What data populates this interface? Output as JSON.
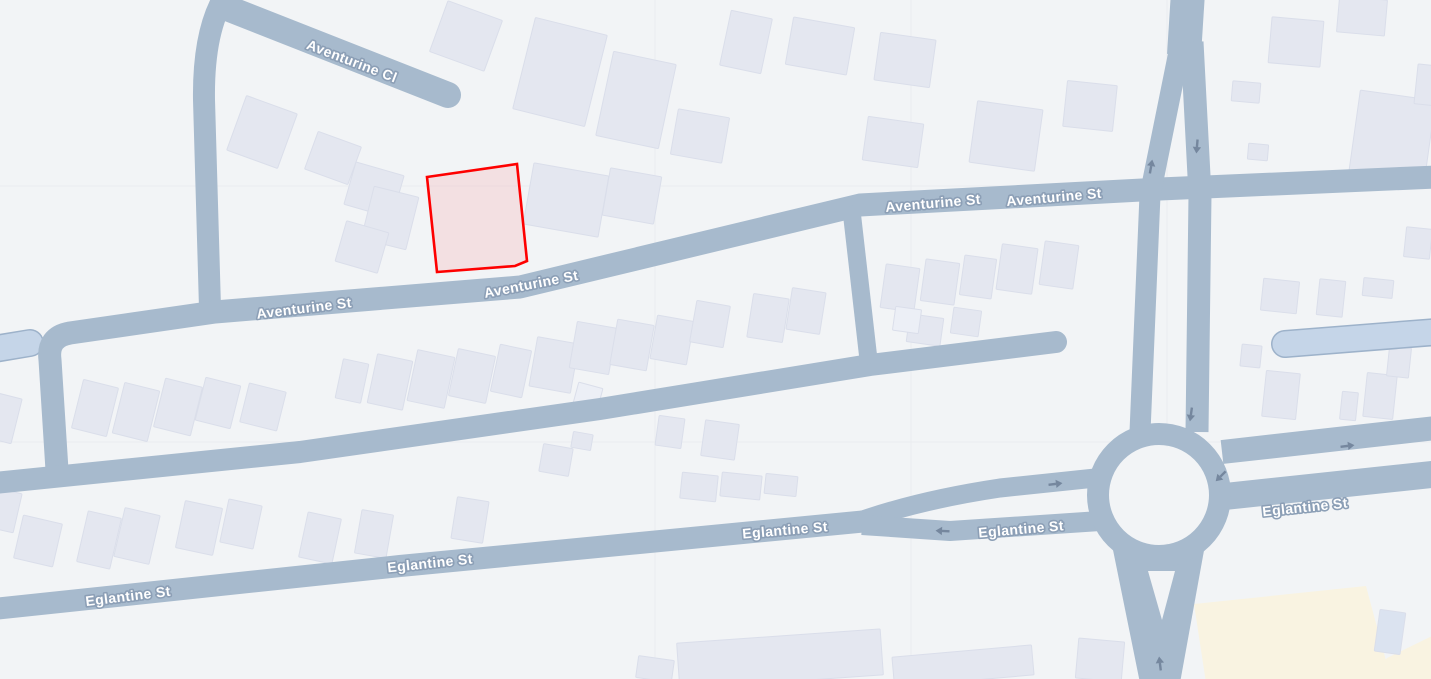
{
  "map": {
    "colors": {
      "bg": "#f2f4f6",
      "tile_line": "#e9ebee",
      "road": "#a7bacd",
      "light_road_fill": "#c5d5e8",
      "light_road_edge": "#9db2ca",
      "building": "#e4e7f0",
      "building_edge": "#dadeea",
      "building_light": "#eceff6",
      "building_blue": "#dbe3f0",
      "landuse": "#f9f3e1",
      "label_fill": "#ffffff",
      "label_halo": "#8c9fb6",
      "arrow": "#75879e",
      "parcel_stroke": "#fe0000",
      "parcel_fill": "rgba(254,0,0,0.08)"
    },
    "labels": [
      {
        "text": "Aventurine Cl",
        "x": 352,
        "y": 61,
        "rot": 21
      },
      {
        "text": "Aventurine St",
        "x": 304,
        "y": 308,
        "rot": -7
      },
      {
        "text": "Aventurine St",
        "x": 531,
        "y": 284,
        "rot": -11
      },
      {
        "text": "Aventurine St",
        "x": 933,
        "y": 203,
        "rot": -5
      },
      {
        "text": "Aventurine St",
        "x": 1054,
        "y": 197,
        "rot": -5
      },
      {
        "text": "Eglantine St",
        "x": 128,
        "y": 596,
        "rot": -7
      },
      {
        "text": "Eglantine St",
        "x": 430,
        "y": 563,
        "rot": -6
      },
      {
        "text": "Eglantine St",
        "x": 785,
        "y": 530,
        "rot": -5
      },
      {
        "text": "Eglantine St",
        "x": 1021,
        "y": 529,
        "rot": -5
      },
      {
        "text": "Eglantine St",
        "x": 1305,
        "y": 507,
        "rot": -6
      }
    ],
    "arrows": [
      {
        "x": 1151,
        "y": 167,
        "rot": -80
      },
      {
        "x": 1197,
        "y": 146,
        "rot": 95
      },
      {
        "x": 1191,
        "y": 414,
        "rot": 98
      },
      {
        "x": 1221,
        "y": 476,
        "rot": 135
      },
      {
        "x": 1347,
        "y": 446,
        "rot": -7
      },
      {
        "x": 1055,
        "y": 484,
        "rot": -7
      },
      {
        "x": 943,
        "y": 531,
        "rot": 183
      },
      {
        "x": 1160,
        "y": 664,
        "rot": -97
      }
    ],
    "roads": [
      {
        "d": "M 222 6 L 448 95",
        "w": 26,
        "cap": "round"
      },
      {
        "d": "M 226 -6 Q 203 30 204 100 L 210 308",
        "w": 22,
        "cap": "butt"
      },
      {
        "d": "M 57 470 L 50 360 Q 47 337 70 333 L 215 312 L 520 287 L 860 205 L 1160 189 L 1436 177",
        "w": 23,
        "cap": "butt"
      },
      {
        "d": "M -6 483 L 300 452 L 600 409 L 870 365 L 1056 342",
        "w": 22,
        "cap": "round"
      },
      {
        "d": "M 851 206 L 869 364",
        "w": 18,
        "cap": "butt"
      },
      {
        "d": "M -6 609 L 400 566 L 868 521",
        "w": 22,
        "cap": "butt"
      },
      {
        "d": "M 860 521 Q 920 500 1000 488 L 1105 477",
        "w": 19,
        "cap": "butt"
      },
      {
        "d": "M 862 525 L 950 531 L 1100 521",
        "w": 20,
        "cap": "butt"
      },
      {
        "d": "M 1222 452 L 1436 428",
        "w": 24,
        "cap": "butt"
      },
      {
        "d": "M 1220 497 L 1436 474",
        "w": 27,
        "cap": "butt"
      },
      {
        "d": "M 1188 -8 L 1184 55",
        "w": 34,
        "cap": "butt"
      },
      {
        "d": "M 1181 42 L 1150 195 L 1140 432",
        "w": 21,
        "cap": "butt"
      },
      {
        "d": "M 1192 42 L 1200 195 L 1197 432",
        "w": 23,
        "cap": "butt"
      }
    ],
    "light_roads": [
      {
        "d": "M -6 349 L 30 343",
        "w": 25
      },
      {
        "d": "M 1285 344 L 1436 332",
        "w": 25
      }
    ],
    "roundabout": {
      "cx": 1159,
      "cy": 495,
      "ring_r": 61,
      "ring_w": 22,
      "hole_r": 49
    },
    "south_leg": {
      "poly": "1112,545 1205,545 1180,683 1140,683",
      "island": "1148,571 1175,571 1162,620"
    },
    "landuse": [
      "1194,604 1366,586 1392,683 1206,683",
      "1387,658 1436,634 1436,683 1362,683"
    ],
    "tile_lines": [
      {
        "x1": 655,
        "y1": 0,
        "x2": 655,
        "y2": 679
      },
      {
        "x1": 911,
        "y1": 0,
        "x2": 911,
        "y2": 679
      },
      {
        "x1": 1167,
        "y1": 0,
        "x2": 1167,
        "y2": 679
      },
      {
        "x1": 0,
        "y1": 186,
        "x2": 1431,
        "y2": 186
      },
      {
        "x1": 0,
        "y1": 442,
        "x2": 1431,
        "y2": 442
      }
    ],
    "buildings": [
      [
        262,
        132,
        54,
        58,
        20
      ],
      [
        333,
        158,
        46,
        40,
        20
      ],
      [
        374,
        190,
        50,
        44,
        16
      ],
      [
        466,
        36,
        58,
        54,
        20
      ],
      [
        560,
        72,
        74,
        94,
        14
      ],
      [
        636,
        100,
        64,
        86,
        12
      ],
      [
        700,
        136,
        52,
        46,
        10
      ],
      [
        746,
        42,
        42,
        56,
        12
      ],
      [
        820,
        46,
        62,
        48,
        10
      ],
      [
        893,
        142,
        56,
        44,
        8
      ],
      [
        905,
        60,
        56,
        48,
        8
      ],
      [
        1006,
        136,
        66,
        62,
        8
      ],
      [
        1090,
        106,
        50,
        46,
        6
      ],
      [
        1246,
        92,
        28,
        20,
        5
      ],
      [
        1296,
        42,
        52,
        46,
        5
      ],
      [
        1362,
        16,
        48,
        36,
        5
      ],
      [
        1392,
        138,
        76,
        86,
        8
      ],
      [
        1258,
        152,
        20,
        16,
        5
      ],
      [
        1428,
        85,
        24,
        40,
        6
      ],
      [
        390,
        218,
        46,
        54,
        14
      ],
      [
        566,
        200,
        76,
        62,
        10
      ],
      [
        632,
        196,
        52,
        48,
        10
      ],
      [
        362,
        247,
        44,
        42,
        16
      ],
      [
        3,
        418,
        28,
        46,
        14
      ],
      [
        95,
        408,
        36,
        50,
        14
      ],
      [
        136,
        412,
        36,
        52,
        14
      ],
      [
        178,
        407,
        38,
        50,
        14
      ],
      [
        218,
        403,
        36,
        44,
        14
      ],
      [
        263,
        407,
        38,
        40,
        14
      ],
      [
        352,
        381,
        26,
        40,
        12
      ],
      [
        390,
        382,
        36,
        50,
        12
      ],
      [
        431,
        379,
        38,
        52,
        12
      ],
      [
        472,
        376,
        38,
        48,
        12
      ],
      [
        511,
        371,
        32,
        48,
        12
      ],
      [
        554,
        365,
        42,
        50,
        10
      ],
      [
        588,
        396,
        25,
        22,
        15,
        "light"
      ],
      [
        593,
        348,
        40,
        47,
        10
      ],
      [
        632,
        345,
        37,
        46,
        10
      ],
      [
        672,
        340,
        37,
        44,
        10
      ],
      [
        710,
        324,
        34,
        42,
        10
      ],
      [
        768,
        318,
        36,
        44,
        9
      ],
      [
        806,
        311,
        34,
        42,
        9
      ],
      [
        900,
        288,
        34,
        44,
        8
      ],
      [
        940,
        282,
        34,
        42,
        8
      ],
      [
        978,
        277,
        32,
        40,
        8
      ],
      [
        1017,
        269,
        36,
        46,
        8
      ],
      [
        1059,
        265,
        34,
        44,
        8
      ],
      [
        925,
        330,
        34,
        28,
        8
      ],
      [
        966,
        322,
        28,
        26,
        8
      ],
      [
        907,
        320,
        26,
        24,
        8,
        "light"
      ],
      [
        1280,
        296,
        36,
        32,
        6
      ],
      [
        1331,
        298,
        26,
        36,
        6
      ],
      [
        1378,
        288,
        30,
        18,
        6
      ],
      [
        1418,
        243,
        26,
        30,
        6
      ],
      [
        1251,
        356,
        20,
        22,
        6
      ],
      [
        1281,
        395,
        34,
        46,
        6
      ],
      [
        1349,
        406,
        16,
        28,
        6
      ],
      [
        1380,
        396,
        30,
        44,
        6
      ],
      [
        1399,
        362,
        22,
        30,
        6
      ],
      [
        3,
        510,
        30,
        40,
        13
      ],
      [
        38,
        541,
        40,
        44,
        13
      ],
      [
        99,
        540,
        34,
        52,
        13
      ],
      [
        137,
        536,
        36,
        50,
        13
      ],
      [
        199,
        528,
        38,
        48,
        12
      ],
      [
        241,
        524,
        34,
        44,
        12
      ],
      [
        320,
        538,
        34,
        46,
        12
      ],
      [
        374,
        534,
        32,
        44,
        10
      ],
      [
        470,
        520,
        32,
        42,
        9
      ],
      [
        556,
        460,
        30,
        28,
        10
      ],
      [
        582,
        441,
        20,
        16,
        10
      ],
      [
        670,
        432,
        26,
        30,
        8
      ],
      [
        720,
        440,
        34,
        36,
        8
      ],
      [
        699,
        487,
        36,
        26,
        6
      ],
      [
        741,
        486,
        40,
        24,
        6
      ],
      [
        781,
        485,
        32,
        20,
        6
      ],
      [
        655,
        669,
        36,
        22,
        8
      ],
      [
        780,
        659,
        204,
        46,
        -4
      ],
      [
        963,
        666,
        140,
        30,
        -5
      ],
      [
        1100,
        660,
        46,
        40,
        5
      ],
      [
        1390,
        632,
        26,
        42,
        8,
        "blue"
      ]
    ],
    "parcel": {
      "points": "427,177 517,164 527,261 515,266 437,272"
    }
  }
}
